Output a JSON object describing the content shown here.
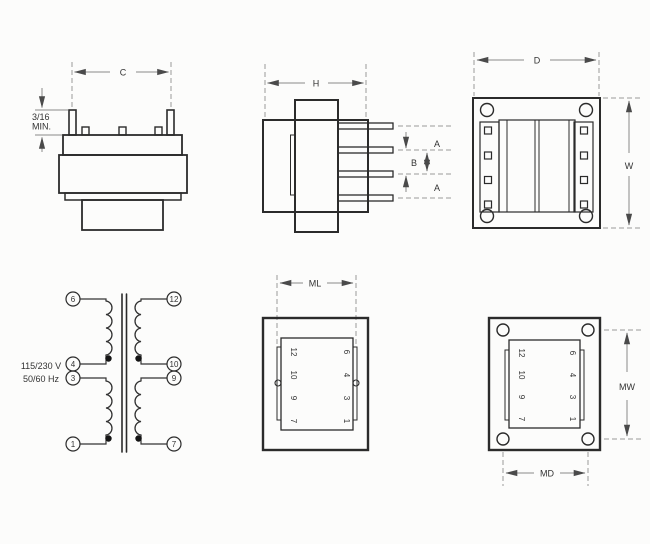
{
  "drawing": {
    "front_view": {
      "dim_c": "C",
      "lead_min_line1": "3/16",
      "lead_min_line2": "MIN."
    },
    "side_view": {
      "dim_h": "H",
      "dim_a_top": "A",
      "dim_b": "B",
      "dim_a_bottom": "A"
    },
    "top_view": {
      "dim_d": "D",
      "dim_w": "W"
    },
    "schematic": {
      "rating_line1": "115/230 V",
      "rating_line2": "50/60 Hz",
      "primary_pins": [
        "6",
        "4",
        "3",
        "1"
      ],
      "secondary_pins": [
        "12",
        "10",
        "9",
        "7"
      ]
    },
    "bottom_open_view": {
      "dim_ml": "ML",
      "left_pins": [
        "12",
        "10",
        "9",
        "7"
      ],
      "right_pins": [
        "6",
        "4",
        "3",
        "1"
      ]
    },
    "bottom_mount_view": {
      "dim_md": "MD",
      "dim_mw": "MW",
      "left_pins": [
        "12",
        "10",
        "9",
        "7"
      ],
      "right_pins": [
        "6",
        "4",
        "3",
        "1"
      ]
    }
  }
}
